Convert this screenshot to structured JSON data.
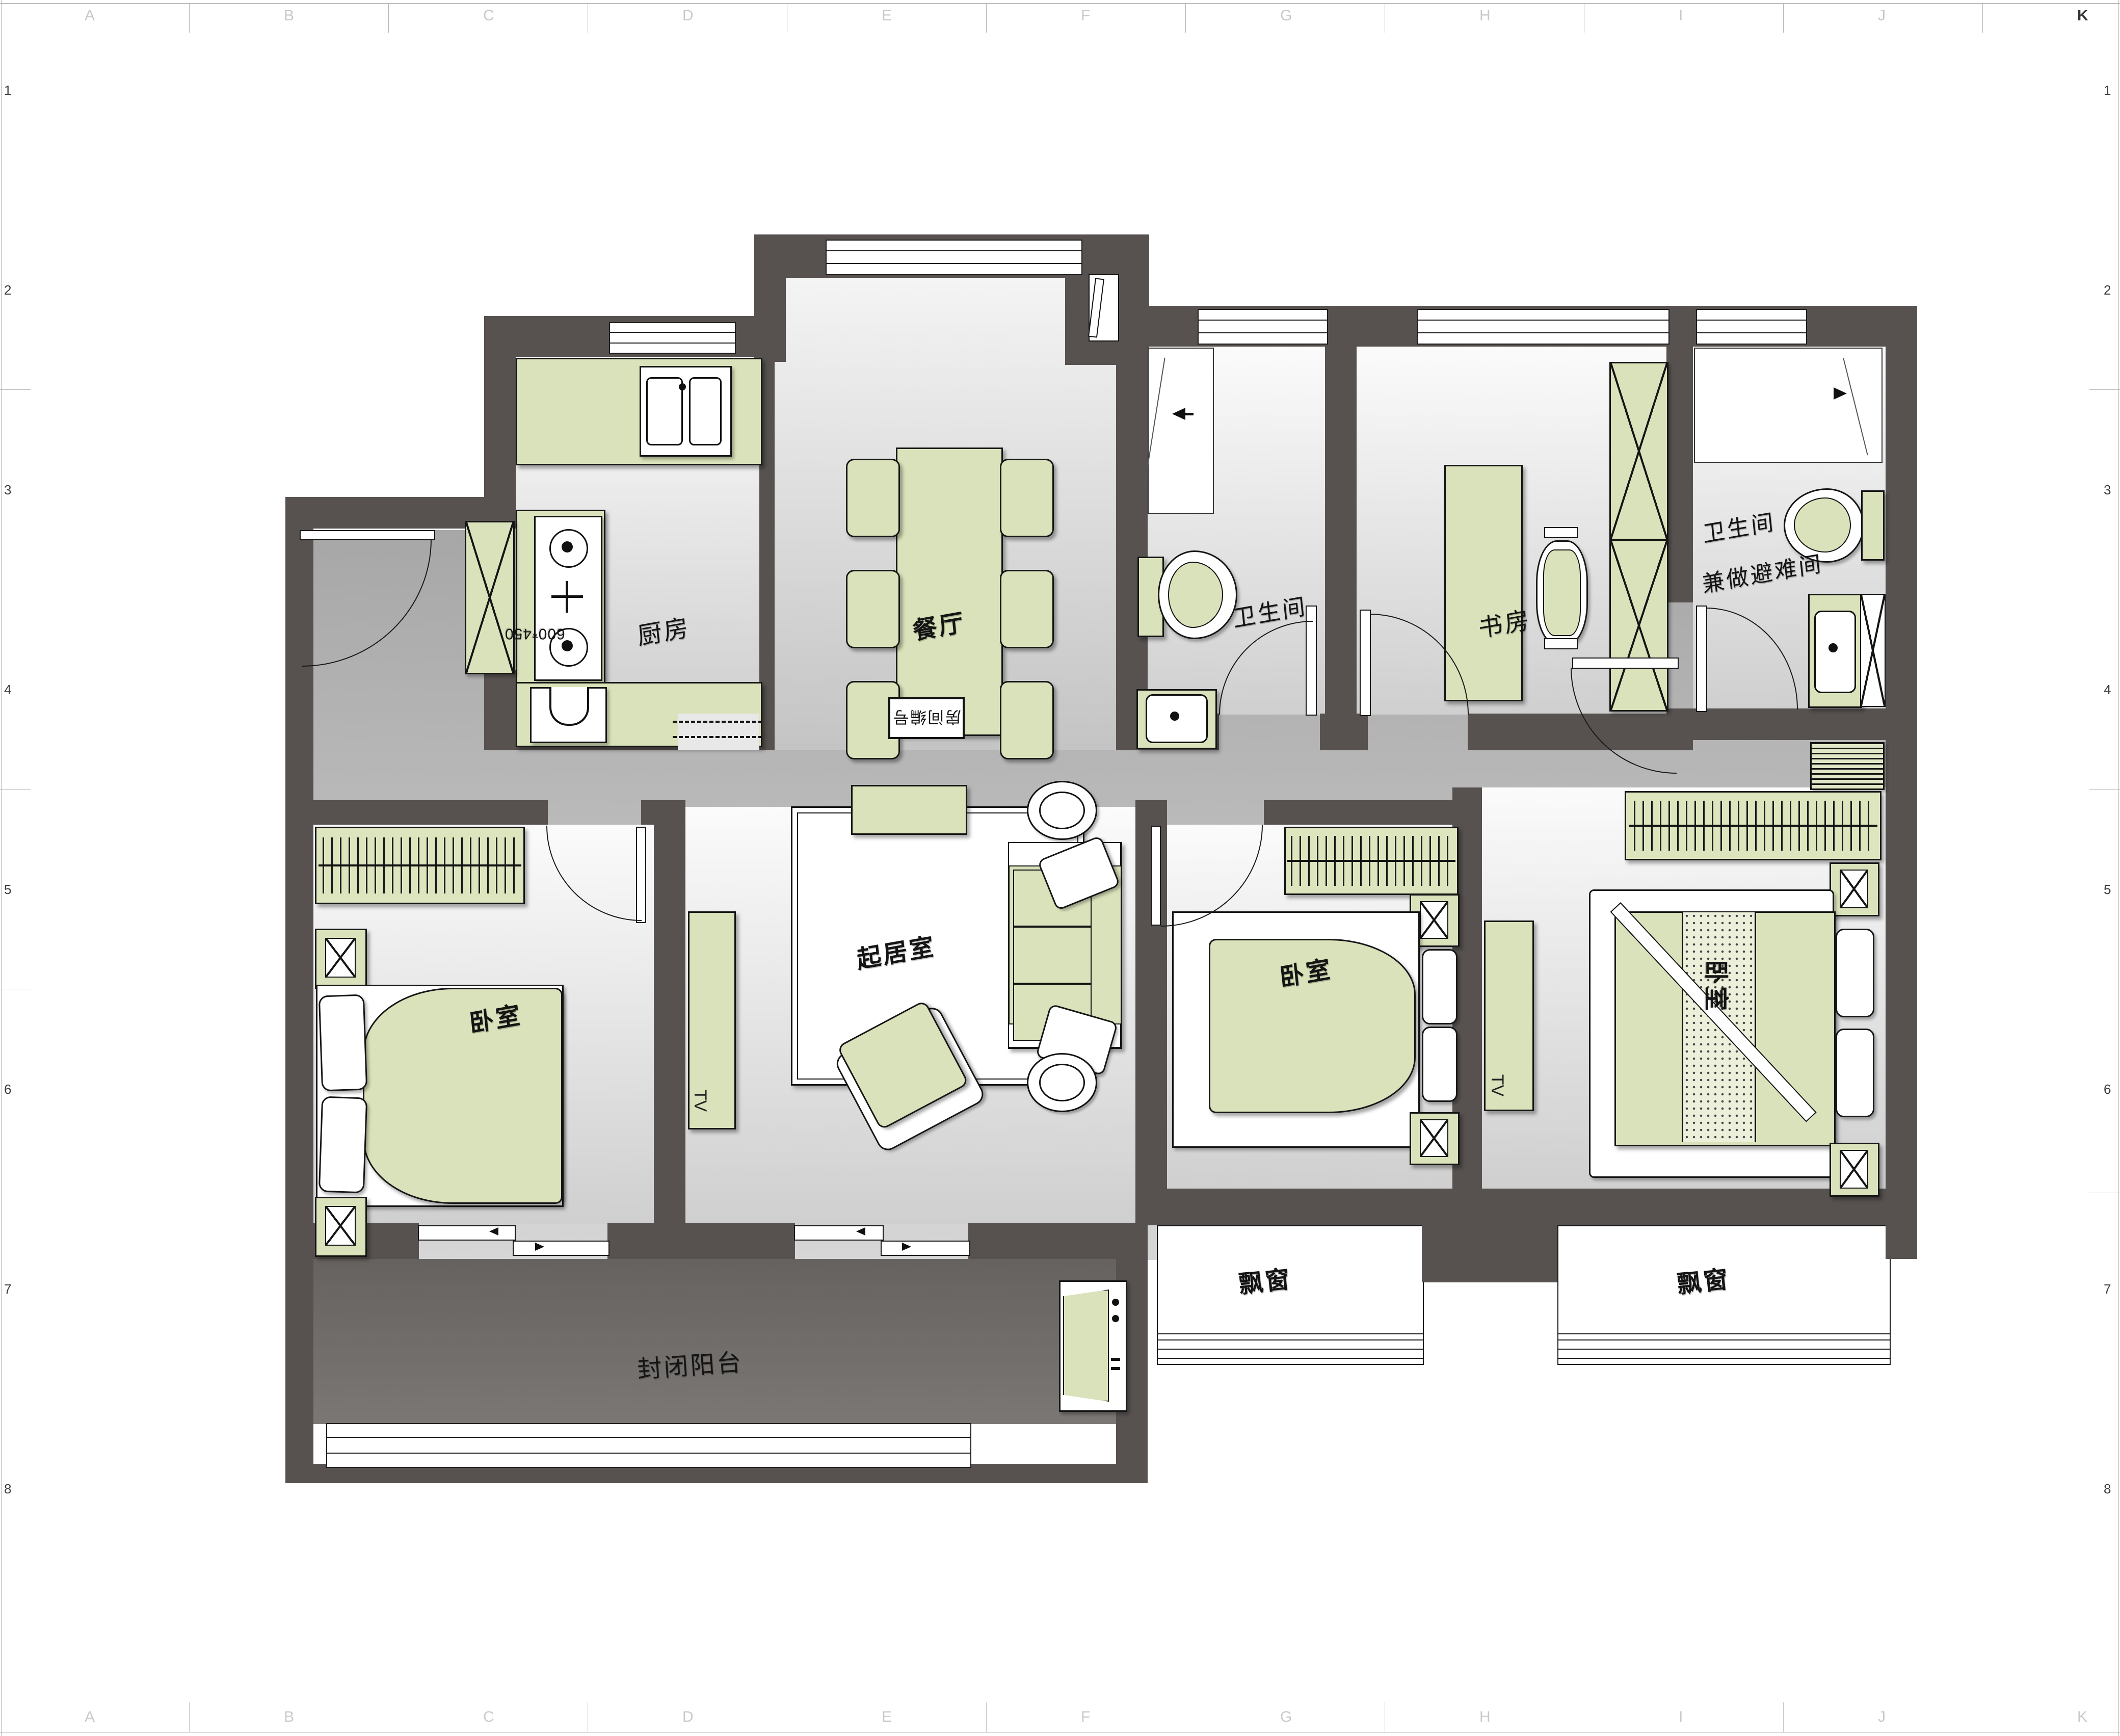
{
  "rooms": {
    "kitchen": "厨房",
    "dining": "餐厅",
    "bathroom": "卫生间",
    "study": "书房",
    "bathroom_refuge_l2": "兼做避难间",
    "bedroom": "卧室",
    "living": "起居室",
    "balcony": "封闭阳台",
    "bay_window": "飘窗"
  },
  "annotations": {
    "fridge_dim": "600*450",
    "corridor_tag": "房间编号",
    "tv": "TV"
  },
  "ruler": {
    "letters": [
      "A",
      "B",
      "C",
      "D",
      "E",
      "F",
      "G",
      "H",
      "I",
      "J",
      "K"
    ],
    "numbers": [
      "1",
      "2",
      "3",
      "4",
      "5",
      "6",
      "7",
      "8"
    ]
  },
  "colors": {
    "wall": "#575250",
    "furniture_green": "#d9e2ba",
    "floor_light": "#fbfbfb",
    "floor_gray": "#cfcfcf",
    "balcony_gray": "#6e6a67"
  }
}
